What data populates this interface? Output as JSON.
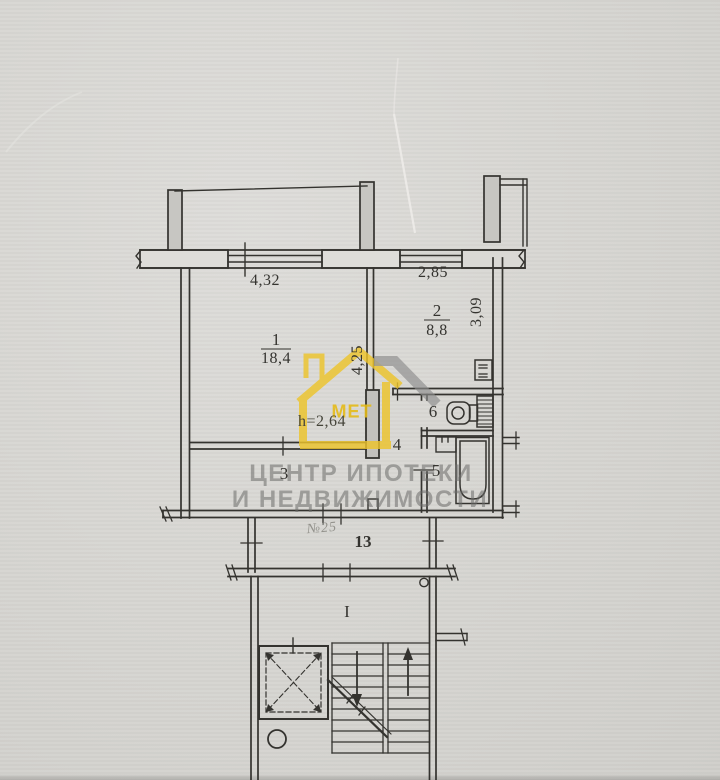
{
  "watermark": {
    "line1": "ЦЕНТР ИПОТЕКИ",
    "line2": "И НЕДВИЖИМОСТИ",
    "logo_text": "МЕТ"
  },
  "plan": {
    "rooms": [
      {
        "number": "1",
        "area": "18,4"
      },
      {
        "number": "2",
        "area": "8,8"
      },
      {
        "number": "3"
      },
      {
        "number": "4"
      },
      {
        "number": "5"
      },
      {
        "number": "6"
      }
    ],
    "dimensions": {
      "room1_width": "4,32",
      "kitchen_width": "2,85",
      "kitchen_depth": "3,09",
      "room1_depth": "4,25",
      "ceiling_height": "h=2,64"
    },
    "landing_number": "13",
    "apartment_number": "№25",
    "stair_flight_label": "I"
  },
  "colors": {
    "paper": "#d8d7d3",
    "ink": "#34332f",
    "watermark_gray": "#8e8e8e",
    "logo_yellow": "#edc42c"
  }
}
